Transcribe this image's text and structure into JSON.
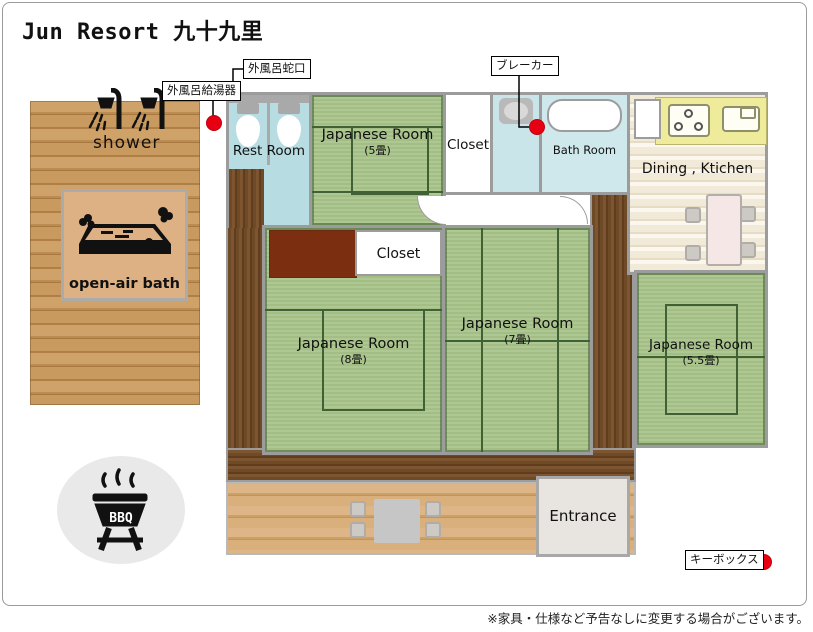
{
  "title": "Jun Resort 九十九里",
  "outdoor": {
    "shower_label": "shower",
    "open_air_bath_label": "open-air bath",
    "bbq_label": "BBQ"
  },
  "callouts": {
    "faucet": "外風呂蛇口",
    "heater": "外風呂給湯器",
    "breaker": "ブレーカー",
    "keybox": "キーボックス"
  },
  "rooms": {
    "rest_room": {
      "label": "Rest Room"
    },
    "jp5": {
      "label": "Japanese Room",
      "size": "(5畳)"
    },
    "closet1": {
      "label": "Closet"
    },
    "bath": {
      "label": "Bath Room"
    },
    "dining": {
      "label": "Dining , Ktichen"
    },
    "closet2": {
      "label": "Closet"
    },
    "jp8": {
      "label": "Japanese Room",
      "size": "(8畳)"
    },
    "jp7": {
      "label": "Japanese Room",
      "size": "(7畳)"
    },
    "jp55": {
      "label": "Japanese Room",
      "size": "(5.5畳)"
    },
    "entrance": {
      "label": "Entrance"
    }
  },
  "footer": {
    "note": "※家具・仕様など予告なしに変更する場合がございます。"
  },
  "colors": {
    "marker_red": "#e60012",
    "tatami_green": "#a8c28c",
    "engawa_brown": "#6f4a27",
    "water_blue": "#b7dde3",
    "kitchen_counter_yellow": "#eeeb9b",
    "wall_gray": "#9c9c9c"
  }
}
